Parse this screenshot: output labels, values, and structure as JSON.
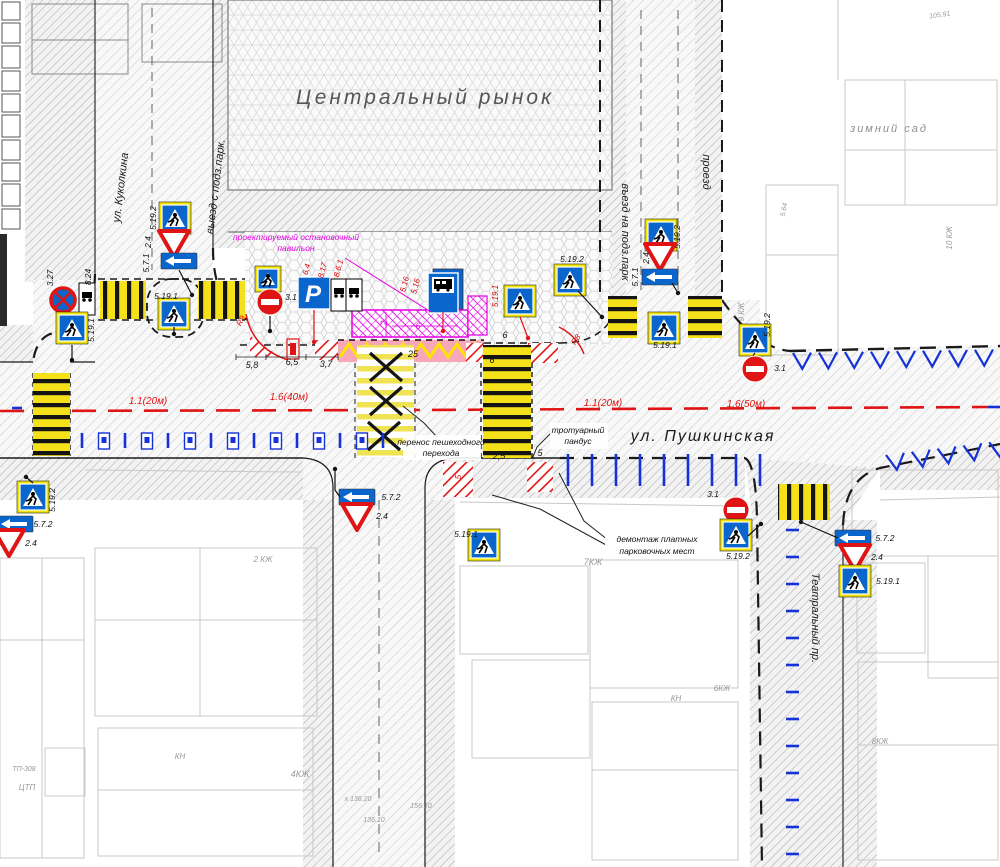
{
  "colors": {
    "sign_blue": "#0a66cc",
    "marking_blue": "#1531d8",
    "marking_red": "#e01414",
    "magenta": "#e500e5",
    "zebra_yellow": "#f5e11a",
    "bus_bay_pink": "#f7a8b8",
    "sign_yellow_border": "#f2e500"
  },
  "map": {
    "place_labels": [
      {
        "name": "central-market-label",
        "text": "Центральный рынок",
        "x": 425,
        "y": 104,
        "size": 21,
        "color": "#555555",
        "ls": 3
      },
      {
        "name": "winter-garden-label",
        "text": "зимний сад",
        "x": 889,
        "y": 132,
        "size": 11,
        "color": "#8f8f8f",
        "ls": 2
      }
    ],
    "street_labels": [
      {
        "name": "pushkinskaya",
        "text": "ул. Пушкинская",
        "x": 703,
        "y": 441,
        "size": 16,
        "rot": 0,
        "ls": 2,
        "color": "#1b1b1b"
      },
      {
        "name": "kukolkina",
        "text": "ул. Куколкина",
        "x": 124,
        "y": 188,
        "size": 11,
        "rot": -83,
        "color": "#1b1b1b"
      },
      {
        "name": "exit-underground-parking",
        "text": "выезд с подз.парк.",
        "x": 219,
        "y": 187,
        "size": 11,
        "rot": -83,
        "color": "#1b1b1b"
      },
      {
        "name": "entry-underground-parking",
        "text": "въезд на подз.парк",
        "x": 622,
        "y": 232,
        "size": 11,
        "rot": 90,
        "color": "#1b1b1b"
      },
      {
        "name": "passage",
        "text": "проезд",
        "x": 703,
        "y": 172,
        "size": 11,
        "rot": 90,
        "color": "#1b1b1b"
      },
      {
        "name": "teatralny",
        "text": "Театральный пр.",
        "x": 812,
        "y": 618,
        "size": 11,
        "rot": 90,
        "color": "#1b1b1b"
      }
    ],
    "marking_labels": [
      {
        "text": "1.1(20м)",
        "x": 148,
        "y": 404
      },
      {
        "text": "1.6(40м)",
        "x": 289,
        "y": 400
      },
      {
        "text": "1.1(20м)",
        "x": 603,
        "y": 406
      },
      {
        "text": "1.6(50м)",
        "x": 746,
        "y": 407
      }
    ],
    "dimensions": [
      {
        "text": "5,8",
        "x": 252,
        "y": 368
      },
      {
        "text": "6,5",
        "x": 292,
        "y": 365
      },
      {
        "text": "3,7",
        "x": 326,
        "y": 367
      },
      {
        "text": "25",
        "x": 413,
        "y": 357
      },
      {
        "text": "2,5",
        "x": 499,
        "y": 459
      },
      {
        "text": "5",
        "x": 540,
        "y": 456
      },
      {
        "text": "6",
        "x": 505,
        "y": 338
      },
      {
        "text": "6",
        "x": 492,
        "y": 363
      },
      {
        "text": "2",
        "x": 387,
        "y": 323,
        "rot": -90,
        "color": "#e500e5"
      },
      {
        "text": "6",
        "x": 418,
        "y": 329,
        "color": "#e500e5"
      }
    ],
    "red_labels": [
      {
        "text": "6.4",
        "x": 309,
        "y": 270,
        "rot": -75
      },
      {
        "text": "8.17",
        "x": 325,
        "y": 271,
        "rot": -75
      },
      {
        "text": "8.6.1",
        "x": 341,
        "y": 269,
        "rot": -75
      },
      {
        "text": "5.16",
        "x": 407,
        "y": 285,
        "rot": -75
      },
      {
        "text": "5.16",
        "x": 418,
        "y": 287,
        "rot": -75
      },
      {
        "text": "5.19.1",
        "x": 498,
        "y": 296,
        "rot": -90
      },
      {
        "text": "R9",
        "x": 243,
        "y": 322,
        "rot": -60
      },
      {
        "text": "R8",
        "x": 578,
        "y": 341,
        "rot": -55
      },
      {
        "text": "5",
        "x": 461,
        "y": 477,
        "rot": -90
      }
    ],
    "annotations": [
      {
        "name": "pavilion-note",
        "lines": [
          "проектируемый остановочный",
          "павильон"
        ],
        "x": 296,
        "y": 240,
        "lh": 11,
        "color": "#e500e5",
        "leaders": [
          [
            [
              345,
              258
            ],
            [
              431,
              312
            ]
          ]
        ],
        "leader_color": "#e500e5"
      },
      {
        "name": "crossing-move-note",
        "lines": [
          "перенос пешеходного",
          "перехода"
        ],
        "x": 441,
        "y": 445,
        "lh": 11,
        "color": "#111111",
        "box": {
          "x": 403,
          "y": 435,
          "w": 78,
          "h": 25
        },
        "leaders": [
          [
            [
              437,
              437
            ],
            [
              424,
              423
            ],
            [
              403,
              406
            ]
          ]
        ],
        "leader_color": "#222222"
      },
      {
        "name": "sidewalk-ramp-note",
        "lines": [
          "тротуарный",
          "пандус"
        ],
        "x": 578,
        "y": 433,
        "lh": 11,
        "color": "#111111",
        "box": {
          "x": 550,
          "y": 423,
          "w": 58,
          "h": 26
        },
        "leaders": [
          [
            [
              551,
              433
            ],
            [
              537,
              447
            ],
            [
              532,
              459
            ]
          ]
        ],
        "leader_color": "#222222"
      },
      {
        "name": "parking-demolition-note",
        "lines": [
          "демонтаж платных",
          "парковочных мест"
        ],
        "x": 657,
        "y": 542,
        "lh": 12,
        "color": "#111111",
        "box": {
          "x": 605,
          "y": 532,
          "w": 104,
          "h": 27
        },
        "leaders": [
          [
            [
              608,
              540
            ],
            [
              584,
              521
            ],
            [
              559,
              473
            ]
          ],
          [
            [
              608,
              546
            ],
            [
              540,
              509
            ],
            [
              492,
              495
            ]
          ]
        ],
        "leader_color": "#222222"
      }
    ],
    "crossings": [
      {
        "name": "crossing-west",
        "x": 33,
        "y": 373,
        "w": 37,
        "h": 83,
        "o": "h"
      },
      {
        "name": "crossing-kukolkina-1",
        "x": 100,
        "y": 281,
        "w": 46,
        "h": 38,
        "o": "v"
      },
      {
        "name": "crossing-kukolkina-2",
        "x": 198,
        "y": 281,
        "w": 47,
        "h": 38,
        "o": "v"
      },
      {
        "name": "crossing-removed",
        "x": 357,
        "y": 345,
        "w": 57,
        "h": 112,
        "o": "h",
        "faded": true,
        "xmarks": [
          [
            386,
            367
          ],
          [
            386,
            401
          ],
          [
            384,
            436
          ]
        ]
      },
      {
        "name": "crossing-new",
        "x": 483,
        "y": 345,
        "w": 48,
        "h": 113,
        "o": "h"
      },
      {
        "name": "crossing-entry-1",
        "x": 608,
        "y": 296,
        "w": 29,
        "h": 42,
        "o": "h"
      },
      {
        "name": "crossing-entry-2",
        "x": 688,
        "y": 296,
        "w": 34,
        "h": 42,
        "o": "h"
      },
      {
        "name": "crossing-teatralny",
        "x": 778,
        "y": 484,
        "w": 52,
        "h": 36,
        "o": "v"
      }
    ],
    "tick_rows": [
      {
        "kind": "meter",
        "x": 82,
        "y": 433,
        "dx": 21.5,
        "n": 15
      },
      {
        "kind": "vtick",
        "x": 568,
        "y": 454,
        "dx": 24,
        "n": 9,
        "len": 32
      },
      {
        "kind": "htick",
        "x": 786,
        "y0": 530,
        "dy": 27,
        "n": 13,
        "len": 13
      }
    ],
    "herringbones": [
      {
        "x": 793,
        "y": 353,
        "n": 8,
        "dx": 26,
        "rot": -1
      },
      {
        "x": 886,
        "y": 455,
        "n": 5,
        "dx": 26,
        "rot": -7
      }
    ],
    "signs": [
      {
        "type": "no-stop",
        "x": 63,
        "y": 300,
        "label": {
          "t": "3.27",
          "x": 53,
          "y": 278,
          "rot": -90
        }
      },
      {
        "type": "plate",
        "x": 87,
        "y": 299,
        "label": {
          "t": "8.24",
          "x": 91,
          "y": 277,
          "rot": -90
        }
      },
      {
        "type": "ped",
        "yb": 1,
        "x": 72,
        "y": 328,
        "label": {
          "t": "5.19.1",
          "x": 94,
          "y": 330,
          "rot": -90
        },
        "pole": [
          [
            72,
            345
          ],
          [
            72,
            360
          ]
        ]
      },
      {
        "type": "ped",
        "yb": 1,
        "x": 174,
        "y": 314,
        "label": {
          "t": "5.19.1",
          "x": 166,
          "y": 299
        },
        "pole": [
          [
            174,
            327
          ],
          [
            174,
            334
          ]
        ]
      },
      {
        "type": "ped",
        "yb": 1,
        "x": 175,
        "y": 218,
        "label": {
          "t": "5.19.2",
          "x": 156,
          "y": 218,
          "rot": -90
        }
      },
      {
        "type": "yield",
        "x": 174,
        "y": 243,
        "label": {
          "t": "2.4",
          "x": 151,
          "y": 242,
          "rot": -90
        }
      },
      {
        "type": "arrow",
        "x": 179,
        "y": 261,
        "label": {
          "t": "5.7.1",
          "x": 149,
          "y": 263,
          "rot": -90
        },
        "pole": [
          [
            179,
            270
          ],
          [
            192,
            295
          ]
        ]
      },
      {
        "type": "ped",
        "yb": 1,
        "s": 20,
        "x": 268,
        "y": 279
      },
      {
        "type": "no-entry",
        "x": 270,
        "y": 302,
        "label": {
          "t": "3.1",
          "x": 291,
          "y": 300
        },
        "pole": [
          [
            270,
            316
          ],
          [
            270,
            331
          ]
        ]
      },
      {
        "type": "parking",
        "glyph": "P",
        "x": 314,
        "y": 293,
        "pole": [
          [
            314,
            310
          ],
          [
            314,
            342
          ]
        ],
        "pc": "#e01414"
      },
      {
        "type": "plate",
        "x": 339,
        "y": 295
      },
      {
        "type": "plate",
        "x": 354,
        "y": 295
      },
      {
        "type": "bus",
        "x": 443,
        "y": 291,
        "pole": [
          [
            443,
            312
          ],
          [
            443,
            331
          ]
        ],
        "pc": "#e01414"
      },
      {
        "type": "ped",
        "yb": 1,
        "x": 520,
        "y": 301,
        "pole": [
          [
            520,
            317
          ],
          [
            528,
            338
          ]
        ],
        "pc": "#e01414"
      },
      {
        "type": "ped",
        "yb": 1,
        "x": 570,
        "y": 280,
        "label": {
          "t": "5.19.2",
          "x": 572,
          "y": 262
        },
        "pole": [
          [
            578,
            291
          ],
          [
            602,
            317
          ]
        ]
      },
      {
        "type": "ped",
        "yb": 1,
        "x": 661,
        "y": 235,
        "label": {
          "t": "5.19.2",
          "x": 680,
          "y": 237,
          "rot": -90
        }
      },
      {
        "type": "yield",
        "x": 660,
        "y": 256,
        "label": {
          "t": "2.4",
          "x": 649,
          "y": 258,
          "rot": -90
        }
      },
      {
        "type": "arrow",
        "x": 660,
        "y": 277,
        "label": {
          "t": "5.7.1",
          "x": 638,
          "y": 277,
          "rot": -90
        },
        "pole": [
          [
            672,
            283
          ],
          [
            678,
            293
          ]
        ]
      },
      {
        "type": "ped",
        "yb": 1,
        "x": 664,
        "y": 328,
        "label": {
          "t": "5.19.1",
          "x": 665,
          "y": 348
        }
      },
      {
        "type": "ped",
        "yb": 1,
        "x": 755,
        "y": 340,
        "label": {
          "t": "5.19.2",
          "x": 770,
          "y": 325,
          "rot": -90
        },
        "pole": [
          [
            755,
            353
          ],
          [
            749,
            361
          ]
        ]
      },
      {
        "type": "no-entry",
        "x": 755,
        "y": 369,
        "label": {
          "t": "3.1",
          "x": 780,
          "y": 371
        }
      },
      {
        "type": "no-entry",
        "x": 736,
        "y": 510,
        "label": {
          "t": "3.1",
          "x": 713,
          "y": 497
        }
      },
      {
        "type": "ped",
        "yb": 1,
        "x": 736,
        "y": 535,
        "label": {
          "t": "5.19.2",
          "x": 738,
          "y": 559
        },
        "pole": [
          [
            748,
            536
          ],
          [
            761,
            524
          ]
        ]
      },
      {
        "type": "arrow",
        "x": 853,
        "y": 538,
        "label": {
          "t": "5.7.2",
          "x": 885,
          "y": 541
        },
        "pole": [
          [
            838,
            538
          ],
          [
            801,
            522
          ]
        ]
      },
      {
        "type": "yield",
        "x": 855,
        "y": 557,
        "label": {
          "t": "2.4",
          "x": 877,
          "y": 560
        }
      },
      {
        "type": "ped",
        "yb": 1,
        "x": 855,
        "y": 581,
        "label": {
          "t": "5.19.1",
          "x": 888,
          "y": 584
        }
      },
      {
        "type": "ped",
        "yb": 1,
        "x": 33,
        "y": 497,
        "label": {
          "t": "5.19.2",
          "x": 55,
          "y": 500,
          "rot": -90
        },
        "pole": [
          [
            33,
            483
          ],
          [
            26,
            477
          ]
        ]
      },
      {
        "type": "arrow",
        "x": 15,
        "y": 524,
        "label": {
          "t": "5.7.2",
          "x": 43,
          "y": 527
        }
      },
      {
        "type": "yield",
        "x": 9,
        "y": 542,
        "label": {
          "t": "2.4",
          "x": 31,
          "y": 546
        }
      },
      {
        "type": "arrow",
        "x": 357,
        "y": 497,
        "label": {
          "t": "5.7.2",
          "x": 391,
          "y": 500
        },
        "pole": [
          [
            340,
            497
          ],
          [
            335,
            490
          ],
          [
            335,
            469
          ]
        ]
      },
      {
        "type": "yield",
        "x": 357,
        "y": 516,
        "label": {
          "t": "2.4",
          "x": 382,
          "y": 519
        }
      },
      {
        "type": "ped",
        "yb": 1,
        "x": 484,
        "y": 545,
        "label": {
          "t": "5.19.1",
          "x": 466,
          "y": 537
        }
      }
    ],
    "bg_labels": [
      {
        "text": "105.91",
        "x": 940,
        "y": 17,
        "size": 7,
        "rot": -8
      },
      {
        "text": "10 КЖ",
        "x": 952,
        "y": 238,
        "size": 8,
        "rot": -90
      },
      {
        "text": "9 КЖ",
        "x": 744,
        "y": 312,
        "size": 8,
        "rot": -90
      },
      {
        "text": "5.64",
        "x": 786,
        "y": 210,
        "size": 7,
        "rot": -80
      },
      {
        "text": "2 КЖ",
        "x": 263,
        "y": 562,
        "size": 8
      },
      {
        "text": "4КЖ",
        "x": 300,
        "y": 777,
        "size": 9
      },
      {
        "text": "7КЖ",
        "x": 593,
        "y": 565,
        "size": 9
      },
      {
        "text": "6КЖ",
        "x": 722,
        "y": 691,
        "size": 8
      },
      {
        "text": "8КЖ",
        "x": 880,
        "y": 744,
        "size": 8
      },
      {
        "text": "КН",
        "x": 676,
        "y": 701,
        "size": 8
      },
      {
        "text": "КН",
        "x": 180,
        "y": 759,
        "size": 8
      },
      {
        "text": "ТП-308",
        "x": 24,
        "y": 771,
        "size": 7
      },
      {
        "text": "ЦТП",
        "x": 27,
        "y": 790,
        "size": 8
      },
      {
        "text": "х 136.20",
        "x": 358,
        "y": 801,
        "size": 7
      },
      {
        "text": "156.10",
        "x": 421,
        "y": 808,
        "size": 7
      },
      {
        "text": "136.10",
        "x": 374,
        "y": 822,
        "size": 7
      }
    ],
    "legend_cells": [
      18,
      20,
      22,
      20,
      18,
      22,
      20,
      18,
      22,
      20
    ]
  }
}
